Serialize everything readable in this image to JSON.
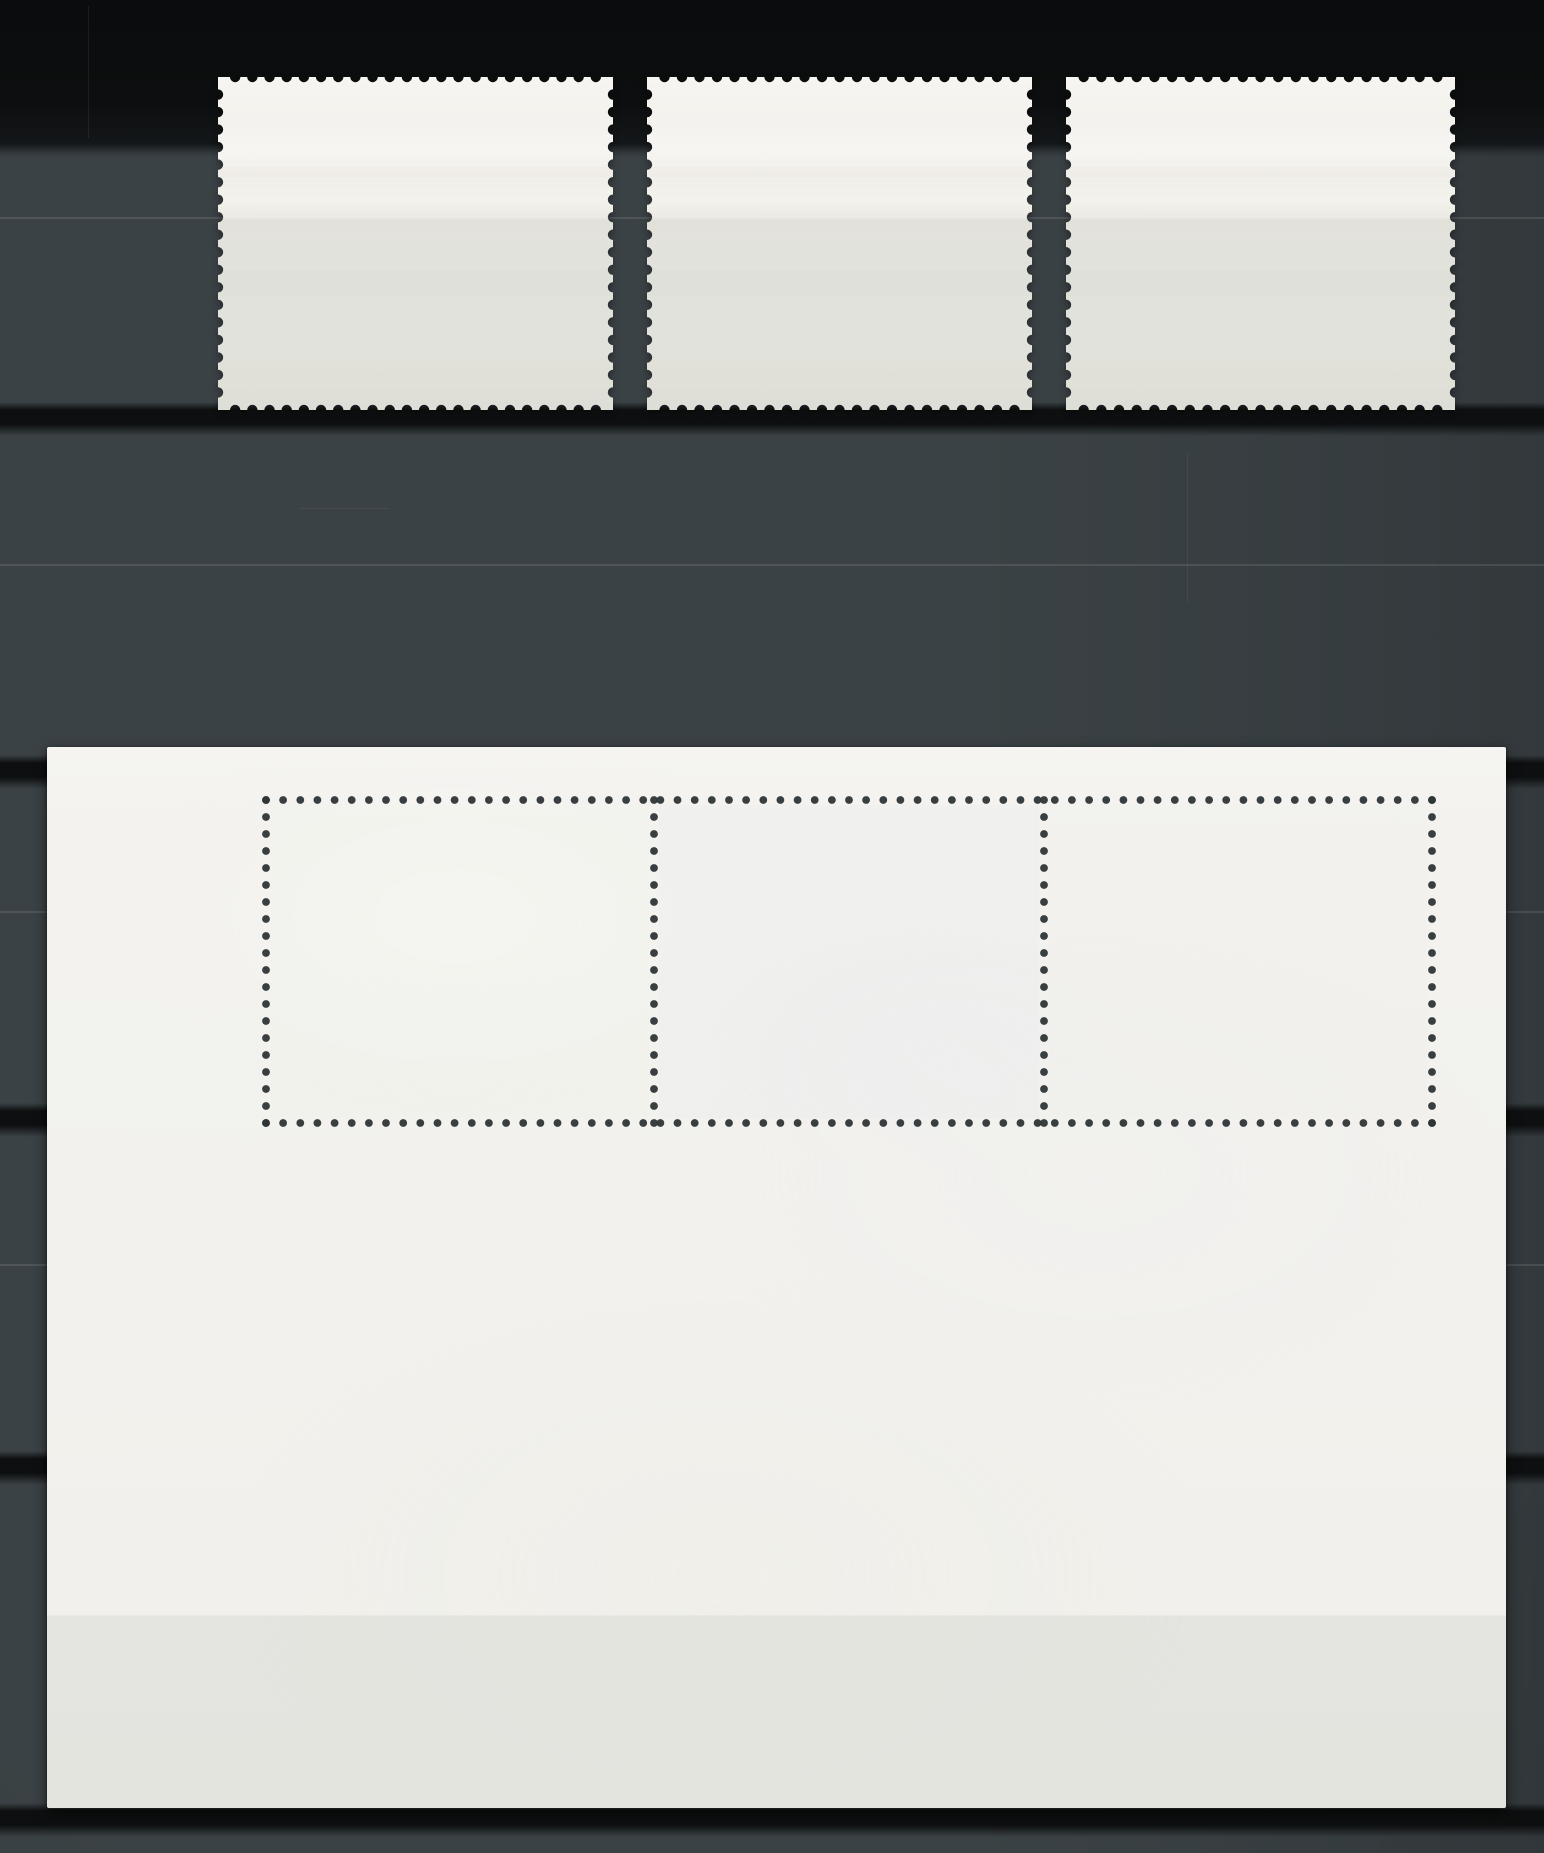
{
  "meta": {
    "description": "Scanned stockbook album page (dark gray with plastic strip pockets) holding the blank gummed backs of three mint postage stamps in the top strip and one large blank souvenir sheet with a perforated three-stamp block below. No text or printing is visible.",
    "canvas": {
      "width": 1544,
      "height": 1853
    }
  },
  "colors": {
    "page_base": "#3b4245",
    "page_top_black": "#0a0c0d",
    "strip_shadow": "#0d0f10",
    "film_line": "rgba(255,255,255,0.10)",
    "stamp_paper_top": "#f6f5f1",
    "stamp_paper_mid": "#f0efe9",
    "stamp_paper_bottom": "#e9e8e1",
    "sheet_paper": "#f2f1ed",
    "perforation_hole": "#2e3536",
    "film_tint": "rgba(138,146,136,0.12)"
  },
  "page": {
    "black_top_height": 152,
    "strip_shadow_bands_y": [
      412,
      765,
      1113,
      1461,
      1813
    ],
    "film_edge_lines_y": [
      218,
      565,
      912,
      1265
    ],
    "band_soft_above": 10,
    "band_soft_below": 24
  },
  "stamps": [
    {
      "id": "stamp-1",
      "x": 218,
      "y": 77,
      "width": 395,
      "height": 333,
      "film_from_y": 141
    },
    {
      "id": "stamp-2",
      "x": 647,
      "y": 77,
      "width": 385,
      "height": 333,
      "film_from_y": 141
    },
    {
      "id": "stamp-3",
      "x": 1066,
      "y": 77,
      "width": 389,
      "height": 333,
      "film_from_y": 141
    }
  ],
  "stamp_perforation": {
    "pitch": 17.3,
    "notch_radius": 5.2
  },
  "sheet": {
    "x": 47,
    "y": 747,
    "width": 1459,
    "height": 1061,
    "film_from_y": 868
  },
  "sheet_perforation": {
    "hole_radius": 3.9,
    "pitch": 17.1,
    "row_y": [
      53,
      376
    ],
    "col_x": [
      219,
      607,
      997,
      1385
    ],
    "x_start": 219,
    "x_end": 1385,
    "y_start": 53,
    "y_end": 376
  },
  "cell_tints": [
    "rgba(240,241,238,0.10)",
    "rgba(226,234,240,0.12)",
    "rgba(232,235,231,0.08)"
  ],
  "scratches": [
    {
      "x": 88,
      "y": 6,
      "width": 1,
      "height": 132,
      "color": "rgba(255,255,255,0.07)"
    },
    {
      "x": 1187,
      "y": 452,
      "width": 1,
      "height": 150,
      "color": "rgba(255,255,255,0.05)"
    },
    {
      "x": 300,
      "y": 508,
      "width": 90,
      "height": 1,
      "color": "rgba(255,255,255,0.05)"
    }
  ]
}
